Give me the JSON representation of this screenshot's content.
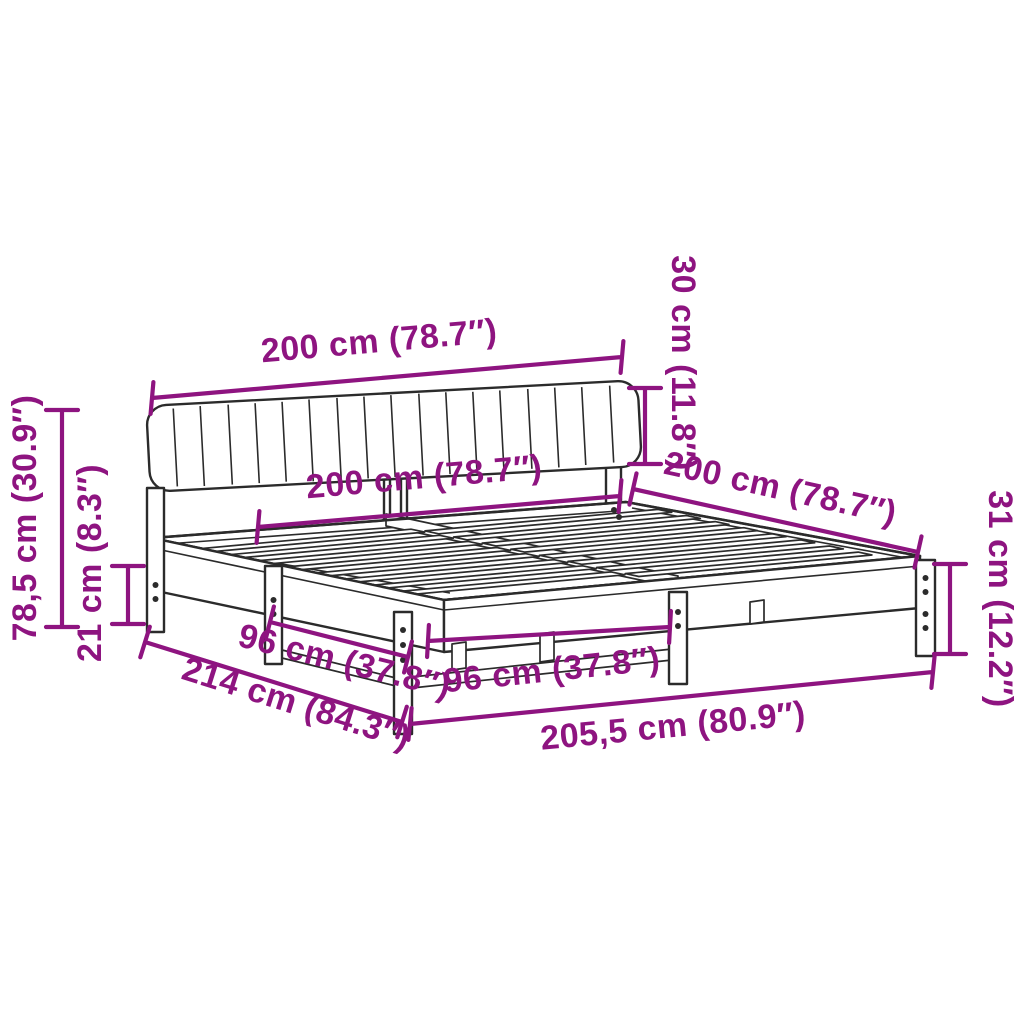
{
  "colors": {
    "dimension_accent": "#8e1480",
    "line_art": "#2b2b2b",
    "background": "#ffffff"
  },
  "diagram": {
    "subject": "bed frame with upholstered headboard - dimension drawing",
    "dimensions": {
      "headboard_width": {
        "label": "200 cm (78.7″)"
      },
      "headboard_height": {
        "label": "30 cm (11.8″)"
      },
      "total_height": {
        "label": "78,5 cm (30.9″)"
      },
      "under_frame_clearance": {
        "label": "21 cm (8.3″)"
      },
      "frame_width": {
        "label": "200 cm (78.7″)"
      },
      "frame_depth": {
        "label": "200 cm (78.7″)"
      },
      "foot_end_height": {
        "label": "31 cm (12.2″)"
      },
      "slat_span_left": {
        "label": "96 cm (37.8″)"
      },
      "slat_span_front": {
        "label": "96 cm (37.8″)"
      },
      "total_depth_diagonal": {
        "label": "214 cm (84.3″)"
      },
      "total_length": {
        "label": "205,5 cm (80.9″)"
      }
    }
  }
}
